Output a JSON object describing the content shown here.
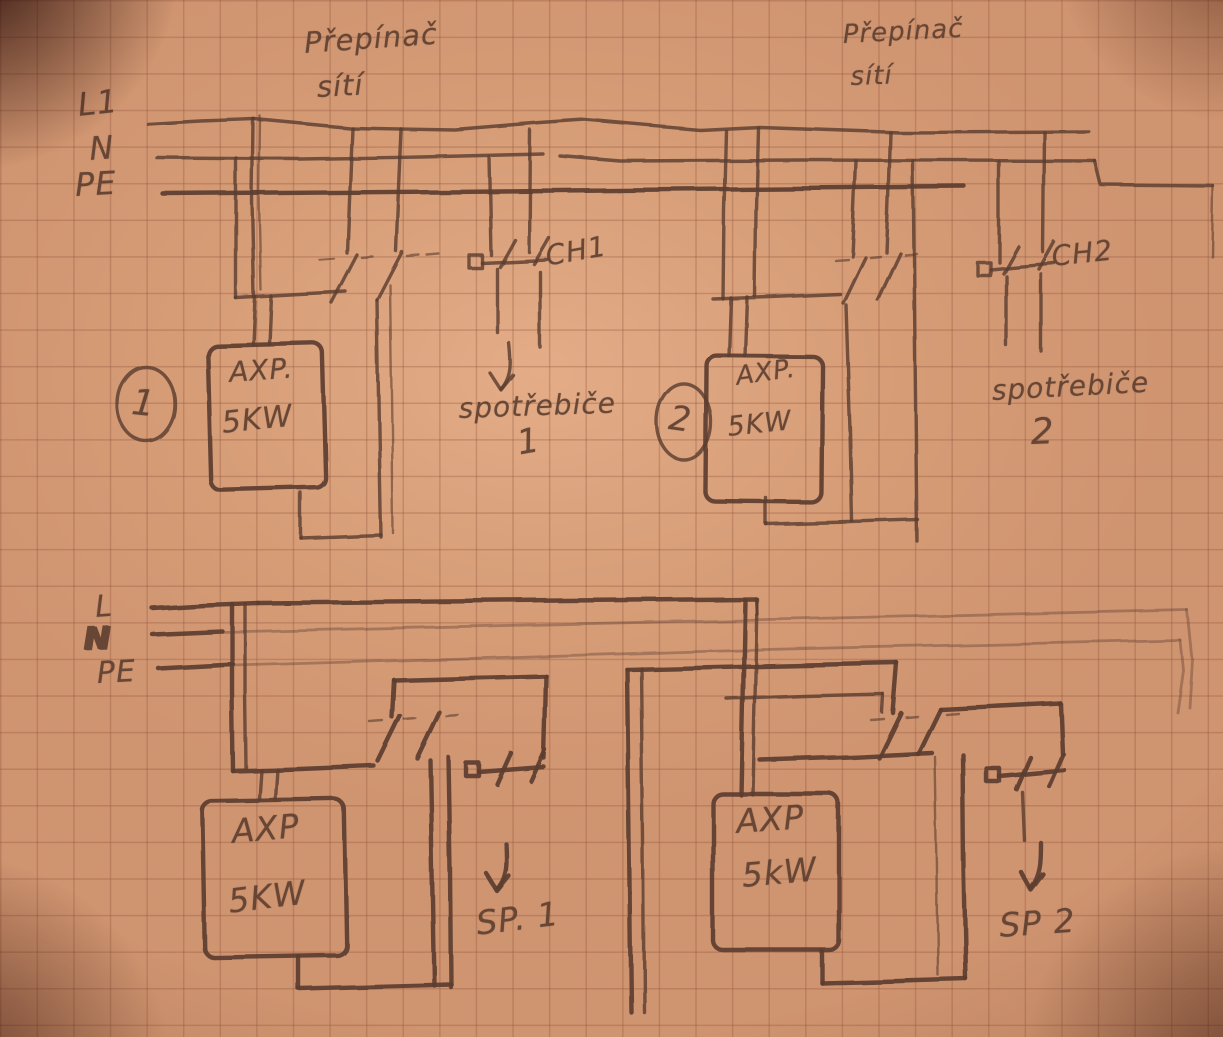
{
  "labels": {
    "bus_top": {
      "l1": "L1",
      "n": "N",
      "pe": "PE"
    },
    "bus_bottom": {
      "l": "L",
      "n": "N",
      "pe": "PE"
    },
    "selector1": {
      "line1": "Přepínač",
      "line2": "sítí"
    },
    "selector2": {
      "line1": "Přepínač",
      "line2": "sítí"
    },
    "circuit1": {
      "number": "1",
      "device_line1": "AXP.",
      "device_line2": "5KW",
      "channel": "CH1",
      "load_line1": "spotřebiče",
      "load_line2": "1"
    },
    "circuit2": {
      "number": "2",
      "device_line1": "AXP.",
      "device_line2": "5KW",
      "channel": "CH2",
      "load_line1": "spotřebiče",
      "load_line2": "2"
    },
    "circuit3": {
      "device_line1": "AXP",
      "device_line2": "5KW",
      "load": "SP. 1"
    },
    "circuit4": {
      "device_line1": "AXP",
      "device_line2": "5kW",
      "load": "SP 2"
    }
  },
  "colors": {
    "paper": "#cf9470",
    "pencil": "#5b3d2f",
    "grid": "#a96f4e"
  }
}
